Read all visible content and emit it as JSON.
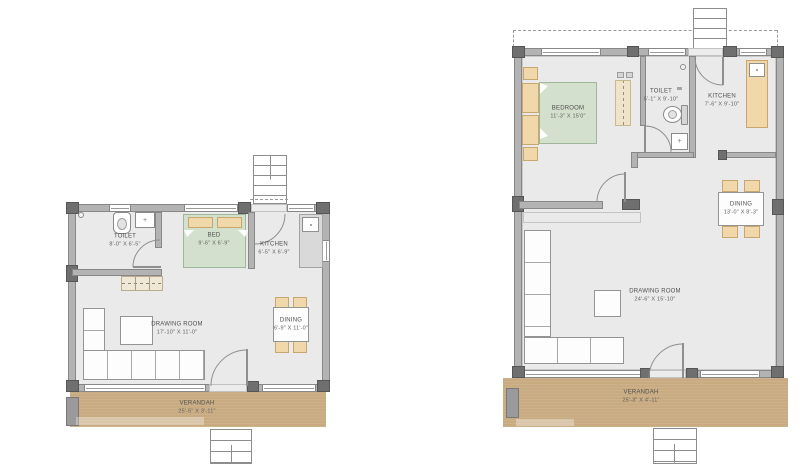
{
  "plan_left": {
    "rooms": {
      "toilet": {
        "name": "TOILET",
        "dims": "8'-0\" X 6'-5\""
      },
      "bed": {
        "name": "BED",
        "dims": "9'-6\" X 6'-9\""
      },
      "kitchen": {
        "name": "KITCHEN",
        "dims": "6'-5\" X 6'-9\""
      },
      "drawing": {
        "name": "DRAWING ROOM",
        "dims": "17'-10\" X 11'-0\""
      },
      "dining": {
        "name": "DINING",
        "dims": "6'-9\" X 11'-0\""
      },
      "verandah": {
        "name": "VERANDAH",
        "dims": "25'-5\" X 3'-11\""
      }
    }
  },
  "plan_right": {
    "rooms": {
      "bedroom": {
        "name": "BEDROOM",
        "dims": "11'-3\" X 15'0\""
      },
      "toilet": {
        "name": "TOILET",
        "dims": "5'-1\" X 9'-10\""
      },
      "kitchen": {
        "name": "KITCHEN",
        "dims": "7'-6\" X 9'-10\""
      },
      "dining": {
        "name": "DINING",
        "dims": "13'-0\" X 8'-3\""
      },
      "drawing": {
        "name": "DRAWING ROOM",
        "dims": "24'-6\" X 15'-10\""
      },
      "verandah": {
        "name": "VERANDAH",
        "dims": "25'-3\" X 4'-11\""
      }
    }
  },
  "fixtures": {
    "basin_plus": "+"
  },
  "colors": {
    "wall": "#b3b3b3",
    "wall_edge": "#878787",
    "column": "#6f6f6f",
    "floor": "#eaeaea",
    "verandah": "#c9ab82",
    "bed_green": "#d3e0cd",
    "furniture_tan": "#f1d8aa",
    "line": "#949494",
    "label_ink": "#4f4f4f",
    "background": "#ffffff"
  }
}
